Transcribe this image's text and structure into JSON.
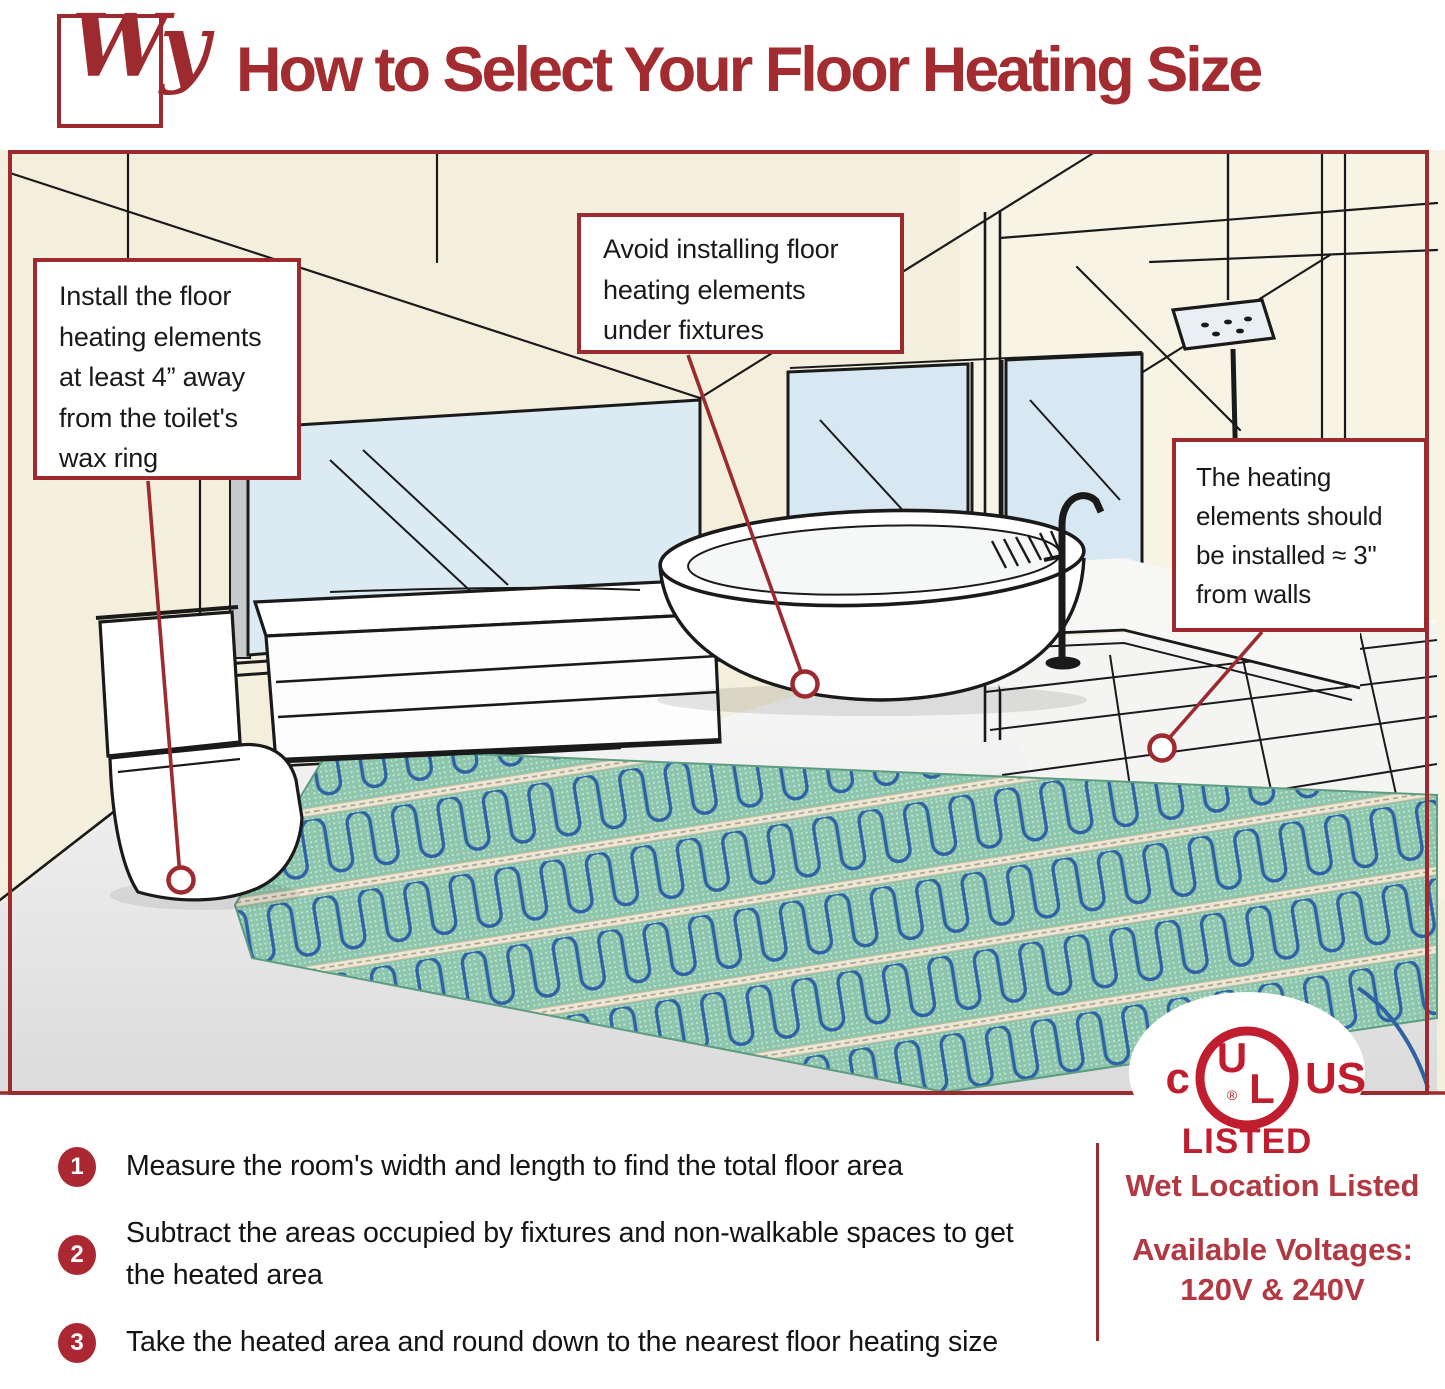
{
  "header": {
    "logo_text": "Wy",
    "title": "How to Select Your Floor Heating Size"
  },
  "callouts": {
    "toilet": "Install the floor\nheating elements\nat least 4” away\nfrom the toilet's\nwax ring",
    "fixtures": "Avoid installing floor\nheating elements\nunder fixtures",
    "walls": "The heating\nelements should\nbe installed ≈ 3\"\nfrom walls"
  },
  "steps": [
    {
      "num": "1",
      "text": "Measure the room's width and length to find the total floor area"
    },
    {
      "num": "2",
      "text": "Subtract the areas occupied by fixtures and non-walkable spaces to get the heated area"
    },
    {
      "num": "3",
      "text": "Take the heated area and round down to the nearest floor heating size"
    }
  ],
  "certification": {
    "c": "c",
    "u": "U",
    "l": "L",
    "reg": "®",
    "us": "US",
    "listed": "LISTED"
  },
  "footer_right": {
    "wet_location": "Wet Location Listed",
    "available_voltages": "Available Voltages:",
    "voltages": "120V & 240V"
  },
  "colors": {
    "brand_red": "#9D2A2F",
    "title_red": "#A32C30",
    "ul_red": "#C01E2E",
    "footer_red": "#B23842",
    "badge_red": "#AB2731",
    "wall_cream": "#F3EFDC",
    "glass_blue": "#D9E8F3",
    "mat_green": "#85C0A6",
    "mat_strip_tan": "#ECE6D6",
    "cable_blue": "#2E62A4"
  }
}
